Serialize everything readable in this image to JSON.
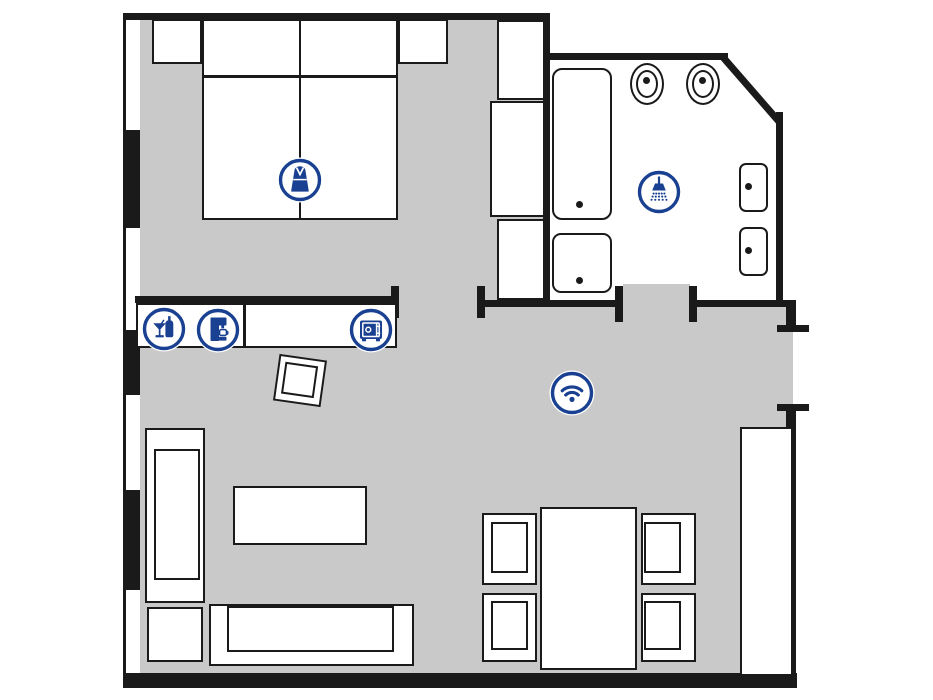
{
  "floorplan": {
    "colors": {
      "wall": "#1a1a1a",
      "floor": "#c9c9c9",
      "icon_blue": "#1a4191",
      "furniture_fill": "#ffffff"
    },
    "amenities": [
      {
        "icon": "bathrobe-icon",
        "label": "Bathrobe"
      },
      {
        "icon": "minibar-icon",
        "label": "Minibar"
      },
      {
        "icon": "coffee-machine-icon",
        "label": "Coffee machine"
      },
      {
        "icon": "safe-icon",
        "label": "Safe"
      },
      {
        "icon": "shower-icon",
        "label": "Shower"
      },
      {
        "icon": "wifi-icon",
        "label": "WiFi"
      }
    ]
  }
}
